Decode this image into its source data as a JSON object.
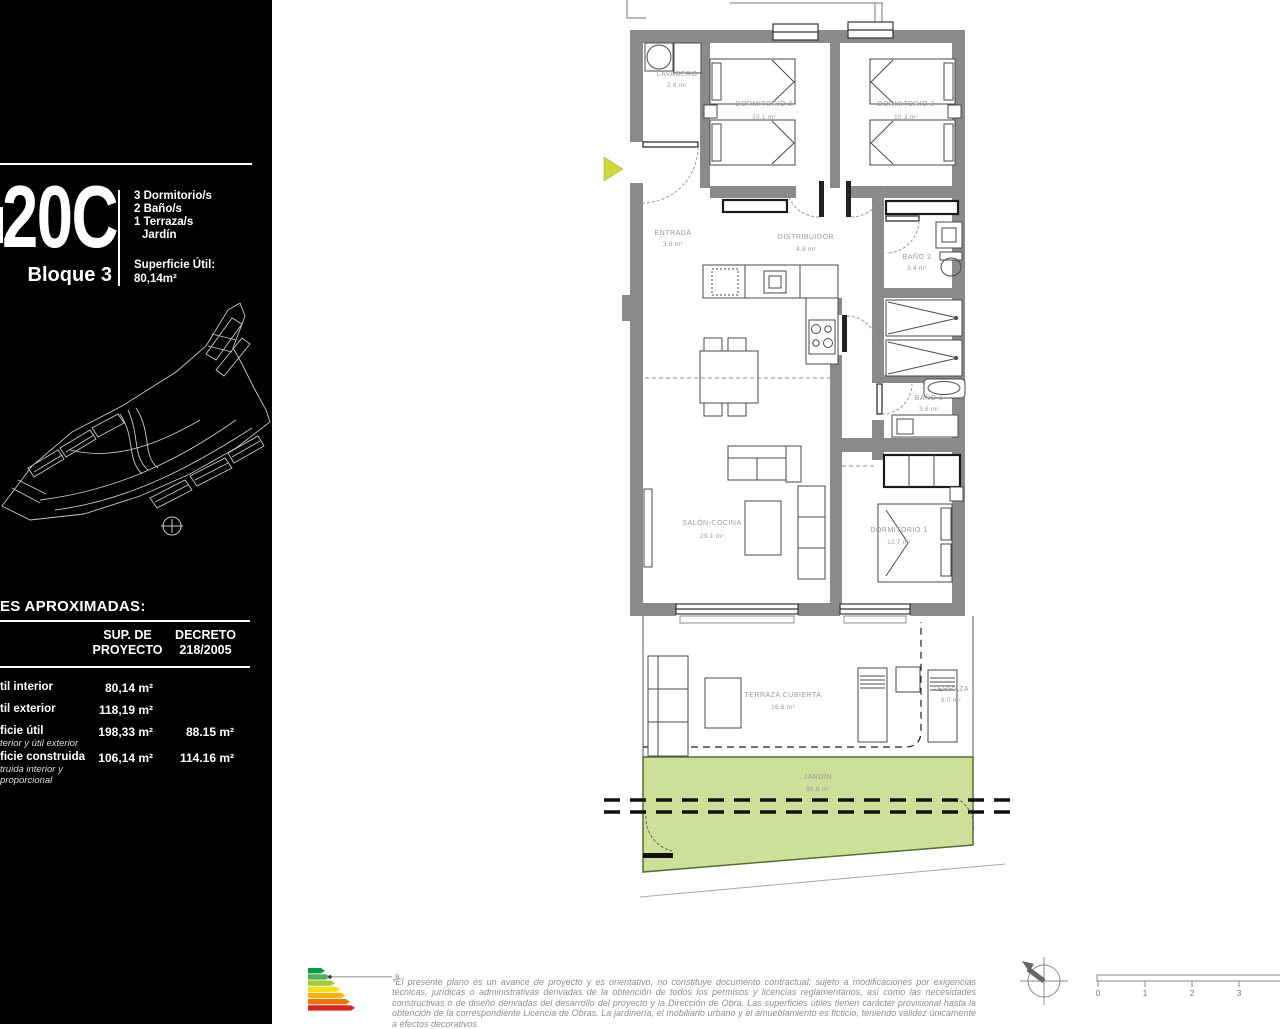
{
  "sidebar": {
    "unit_number": "20C",
    "block": "Bloque 3",
    "features": [
      "3 Dormitorio/s",
      "2 Baño/s",
      "1 Terraza/s",
      "Jardín"
    ],
    "surface_label": "Superficie Útil:",
    "surface_value": "80,14m²",
    "areas_heading": "ES APROXIMADAS:",
    "table": {
      "col1_line1": "SUP. DE",
      "col1_line2": "PROYECTO",
      "col2_line1": "DECRETO",
      "col2_line2": "218/2005",
      "rows": [
        {
          "label": "til interior",
          "sub1": "",
          "sub2": "",
          "proyecto": "80,14 m²",
          "decreto": ""
        },
        {
          "label": "til exterior",
          "sub1": "",
          "sub2": "",
          "proyecto": "118,19 m²",
          "decreto": ""
        },
        {
          "label": "ficie útil",
          "sub1": "terior y útil exterior",
          "sub2": "",
          "proyecto": "198,33 m²",
          "decreto": "88.15 m²"
        },
        {
          "label": "ficie construida",
          "sub1": "truida interior y",
          "sub2": "proporcional",
          "proyecto": "106,14 m²",
          "decreto": "114.16 m²"
        }
      ]
    }
  },
  "plan": {
    "rooms": [
      {
        "name": "LAVADERO",
        "area": "2.6 m²"
      },
      {
        "name": "DORMITORIO 3",
        "area": "10.1 m²"
      },
      {
        "name": "DORMITORIO 2",
        "area": "10.3 m²"
      },
      {
        "name": "ENTRADA",
        "area": "3.6 m²"
      },
      {
        "name": "DISTRIBUIDOR",
        "area": "4.9 m²"
      },
      {
        "name": "BAÑO 2",
        "area": "3.4 m²"
      },
      {
        "name": "BAÑO 1",
        "area": "3.6 m²"
      },
      {
        "name": "SALÓN-COCINA",
        "area": "29.1 m²"
      },
      {
        "name": "DORMITORIO 1",
        "area": "12.7 m²"
      },
      {
        "name": "TERRAZA CUBIERTA",
        "area": "16.6 m²"
      },
      {
        "name": "TERRAZA",
        "area": "8.0 m²"
      },
      {
        "name": "JARDÍN",
        "area": "96.8 m²"
      }
    ]
  },
  "footer": {
    "disclaimer": "*El presente plano es un avance de proyecto y es orientativo, no constituye documento contractual; sujeto a modificaciones por exigencias técnicas, jurídicas o administrativas derivadas de la obtención de todos los permisos y licencias reglamentarios, así como las necesidades constructivas o de diseño derivadas del desarrollo del proyecto y la Dirección de Obra. Las superficies útiles tienen carácter provisional hasta la obtención de la correspondiente Licencia de Obras. La jardinería, el mobiliario urbano y el amueblamiento es ficticio, teniendo validez únicamente a efectos decorativos",
    "energy_rating": "B",
    "scale_ticks": [
      "0",
      "1",
      "2",
      "3"
    ]
  },
  "colors": {
    "sidebar_bg": "#000000",
    "wall_gray": "#8a8a8a",
    "garden_green": "#cde09a",
    "entrance_arrow": "#ccd83f",
    "energy_scale": [
      "#009b48",
      "#52b153",
      "#a5c93c",
      "#f4e019",
      "#f0b310",
      "#e87511",
      "#d9261c"
    ]
  }
}
